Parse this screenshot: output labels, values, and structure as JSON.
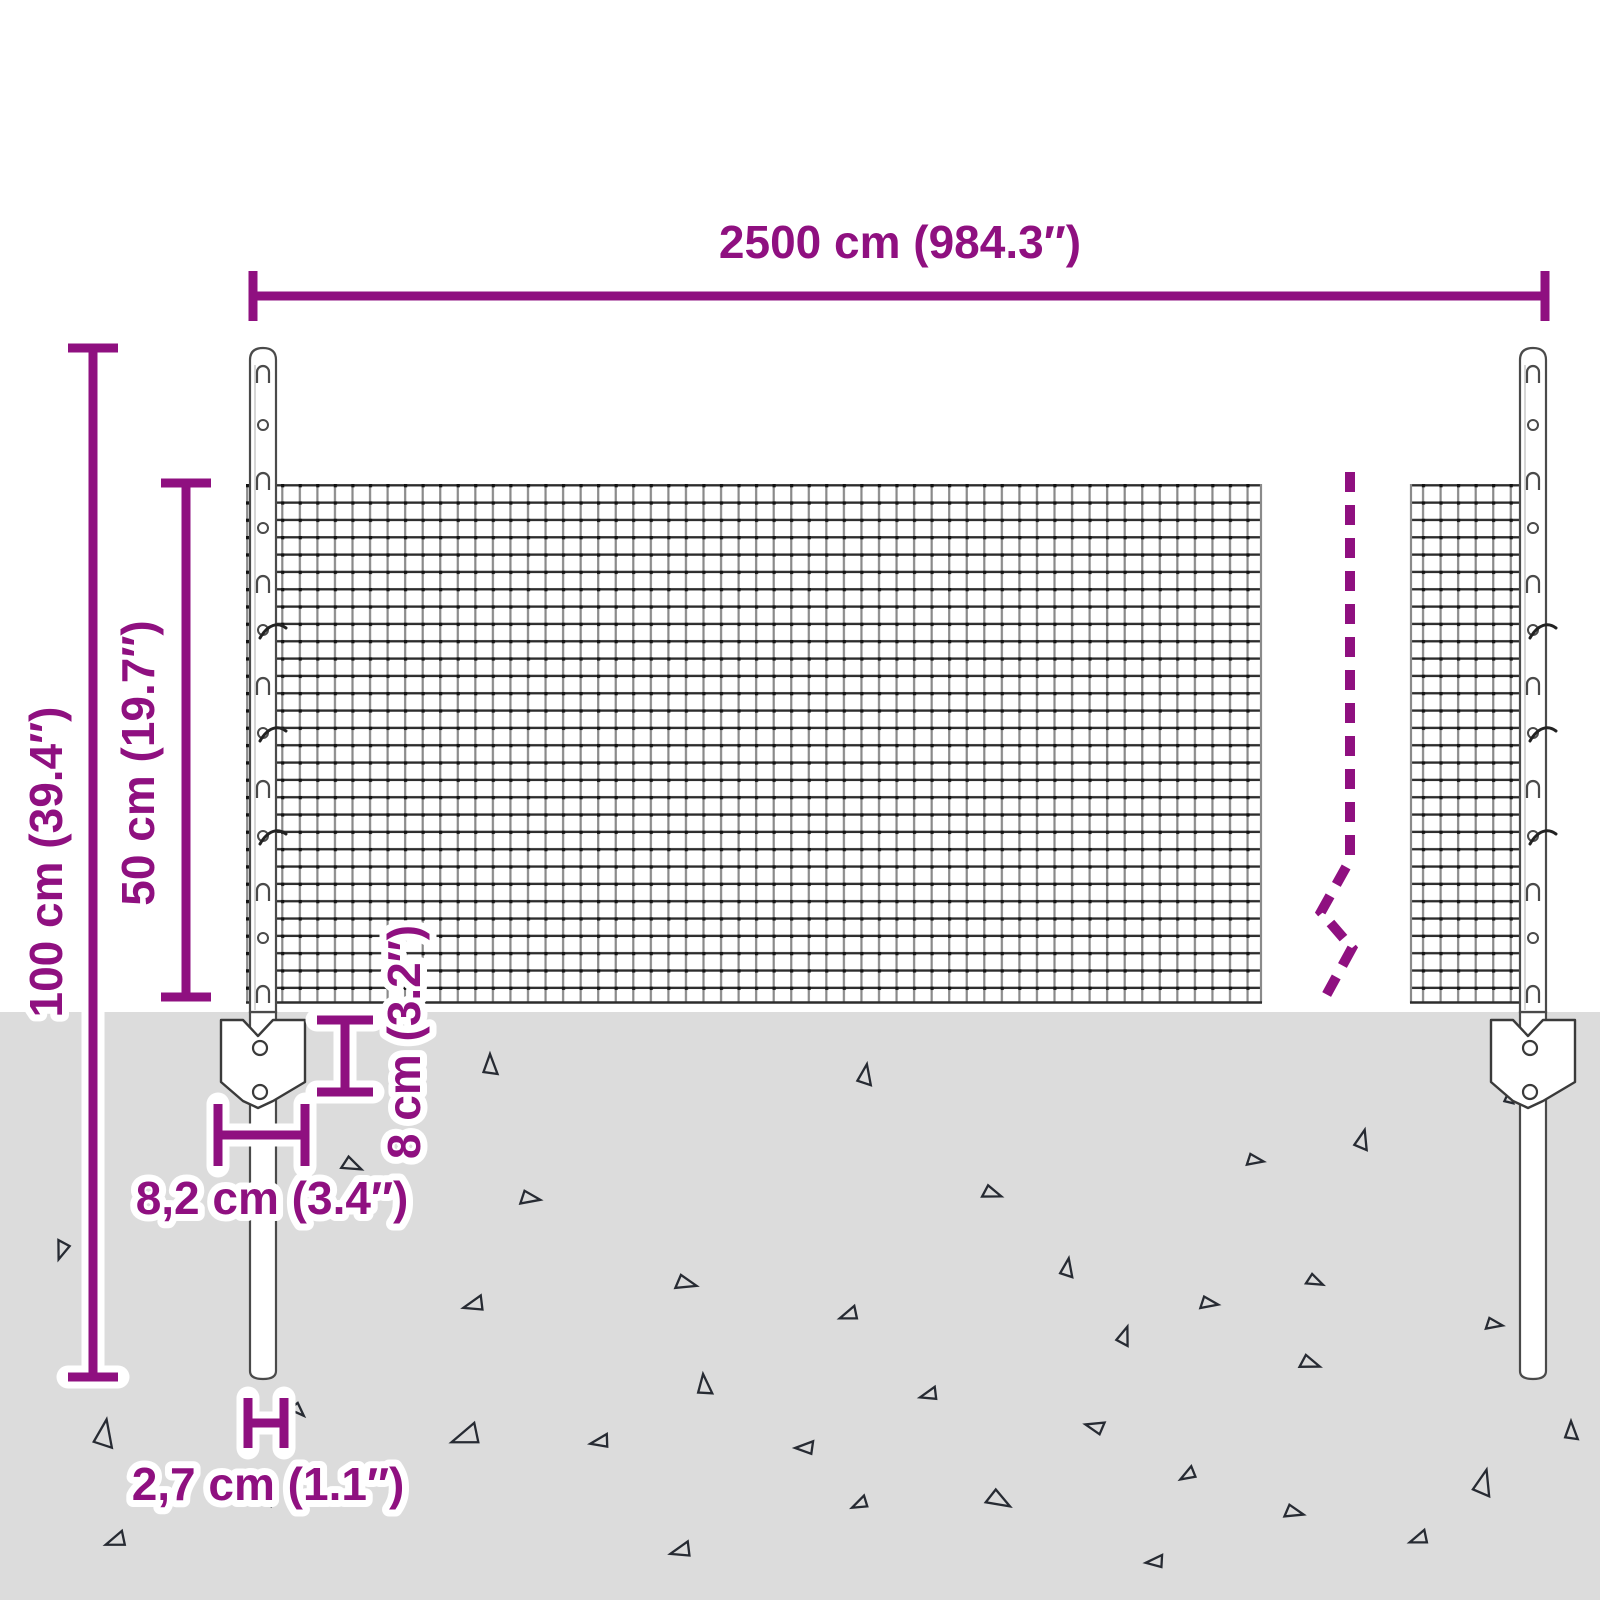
{
  "diagram": {
    "title": "wire-mesh-fence-dimension-diagram",
    "dimensions": {
      "total_width_label": "2500 cm (984.3″)",
      "total_height_label": "100 cm (39.4″)",
      "mesh_height_label": "50 cm (19.7″)",
      "anchor_depth_label": "8 cm (3.2″)",
      "anchor_plate_width_label": "8,2 cm (3.4″)",
      "post_width_label": "2,7 cm (1.1″)"
    },
    "colors": {
      "dimension_accent": "#8F1080",
      "ground": "#DCDCDC",
      "mesh_wire_dark": "#2D2D2D",
      "mesh_wire_light": "#8A8A8A",
      "post_outline": "#4A4A4A",
      "soil_triangle": "#272B33"
    }
  }
}
